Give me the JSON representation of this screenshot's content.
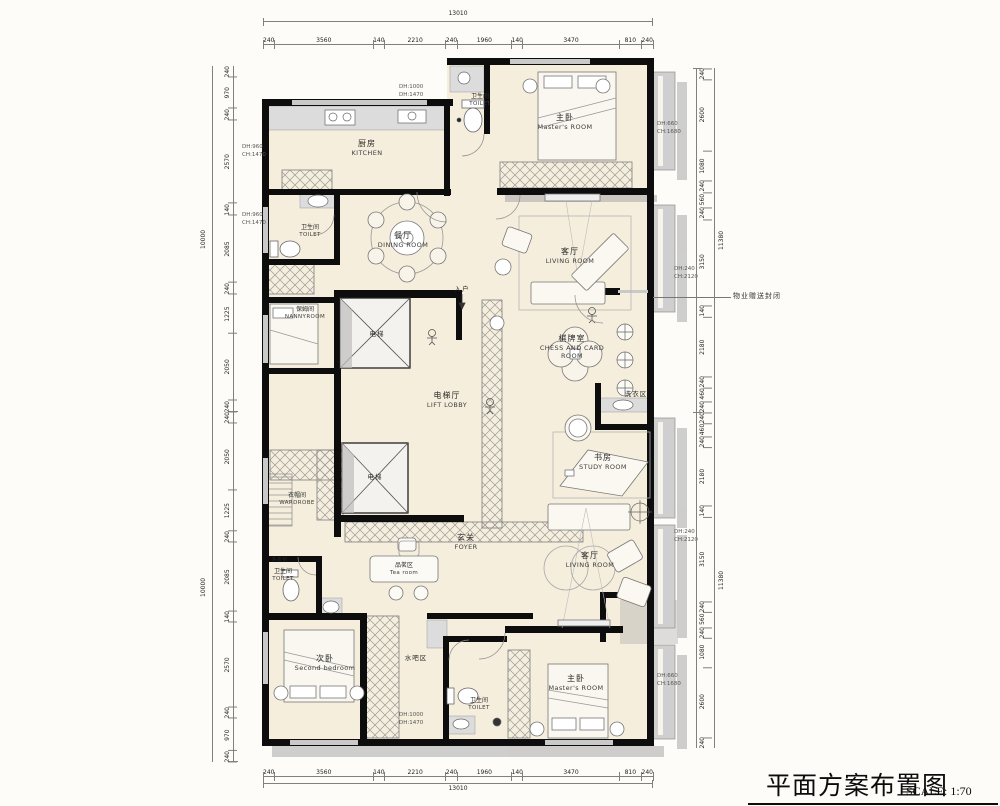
{
  "title": {
    "main": "平面方案布置图",
    "scale": "SCALE: 1:70"
  },
  "dimensions": {
    "top": {
      "total": "13010",
      "segments": [
        240,
        3560,
        140,
        2210,
        240,
        1960,
        140,
        3470,
        810,
        240
      ]
    },
    "bottom": {
      "total": "13010",
      "segments": [
        240,
        3560,
        140,
        2210,
        240,
        1960,
        140,
        3470,
        810,
        240
      ]
    },
    "left": {
      "total_upper": "10000",
      "total_lower": "10000",
      "upper": [
        240,
        970,
        240,
        2570,
        140,
        2085,
        240,
        1225,
        2050,
        240
      ],
      "lower": [
        240,
        2050,
        1225,
        240,
        2085,
        140,
        2570,
        240,
        970,
        240
      ]
    },
    "right": {
      "total_upper": "11380",
      "total_lower": "11380",
      "upper": [
        240,
        2600,
        1080,
        240,
        560,
        240,
        3150,
        140,
        2180,
        240,
        460,
        240
      ],
      "lower": [
        240,
        460,
        240,
        2180,
        140,
        3150,
        240,
        560,
        240,
        1080,
        2600,
        240
      ]
    }
  },
  "rooms": {
    "kitchen": {
      "cn": "厨房",
      "en": "KITCHEN"
    },
    "toilet_top": {
      "cn": "卫生间",
      "en": "TOILET"
    },
    "master_top": {
      "cn": "主卧",
      "en": "Master's ROOM"
    },
    "dining": {
      "cn": "餐厅",
      "en": "DINING ROOM"
    },
    "toilet_left": {
      "cn": "卫生间",
      "en": "TOILET"
    },
    "nanny": {
      "cn": "保姆间",
      "en": "NANNYROOM"
    },
    "living_top": {
      "cn": "客厅",
      "en": "LIVING ROOM"
    },
    "chess": {
      "cn": "棋牌室",
      "en": "CHESS AND CARD ROOM"
    },
    "lift_lobby": {
      "cn": "电梯厅",
      "en": "LIFT LOBBY"
    },
    "elevator_upper": {
      "cn": "电梯"
    },
    "elevator_lower": {
      "cn": "电梯"
    },
    "entry": {
      "cn": "入户"
    },
    "laundry": {
      "cn": "洗衣区"
    },
    "study": {
      "cn": "书房",
      "en": "STUDY ROOM"
    },
    "wardrobe": {
      "cn": "衣帽间",
      "en": "WARDROBE"
    },
    "foyer": {
      "cn": "玄关",
      "en": "FOYER"
    },
    "tea": {
      "cn": "品茗区",
      "en": "Tea room"
    },
    "living_bottom": {
      "cn": "客厅",
      "en": "LIVING ROOM"
    },
    "toilet_lower_left": {
      "cn": "卫生间",
      "en": "TOILET"
    },
    "second_bedroom": {
      "cn": "次卧",
      "en": "Second bedroom"
    },
    "water_bar": {
      "cn": "水吧区"
    },
    "toilet_bottom": {
      "cn": "卫生间",
      "en": "TOILET"
    },
    "master_bottom": {
      "cn": "主卧",
      "en": "Master's ROOM"
    },
    "washer": {
      "cn": "洗衣机"
    }
  },
  "annotations": {
    "dh_top": {
      "l1": "DH:1000",
      "l2": "DH:1470"
    },
    "dh_left_1": {
      "l1": "DH:960",
      "l2": "CH:1470"
    },
    "dh_left_2": {
      "l1": "DH:960",
      "l2": "CH:1470"
    },
    "dh_right_master_top": {
      "l1": "DH:660",
      "l2": "CH:1680"
    },
    "dh_right_living_top": {
      "l1": "DH:240",
      "l2": "CH:2120"
    },
    "dh_right_living_bottom": {
      "l1": "DH:240",
      "l2": "CH:2120"
    },
    "dh_right_master_bottom": {
      "l1": "DH:660",
      "l2": "CH:1680"
    },
    "dh_bottom": {
      "l1": "DH:1000",
      "l2": "DH:1470"
    },
    "gift_label": "物业赠送封闭"
  },
  "colors": {
    "floor": "#f5eedd",
    "wall": "#0d0d0d",
    "gray": "#cfcfcf",
    "dimline": "#808080"
  }
}
